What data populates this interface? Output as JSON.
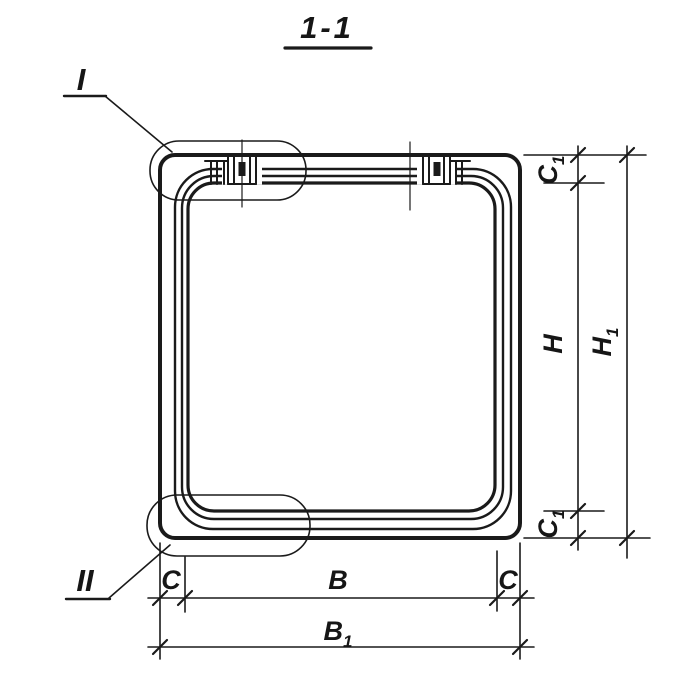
{
  "drawing": {
    "title": "1-1",
    "callouts": {
      "detail_one": "I",
      "detail_two": "II"
    },
    "dimensions": {
      "bottom": {
        "c_left": "C",
        "b_inner": "B",
        "c_right": "C",
        "b_outer_base": "B",
        "b_outer_sub": "1"
      },
      "right": {
        "c1_top_base": "C",
        "c1_top_sub": "1",
        "h_inner": "H",
        "h_outer_base": "H",
        "h_outer_sub": "1",
        "c1_bottom_base": "C",
        "c1_bottom_sub": "1"
      }
    },
    "colors": {
      "ink": "#1a1a1a",
      "background": "#ffffff"
    }
  }
}
